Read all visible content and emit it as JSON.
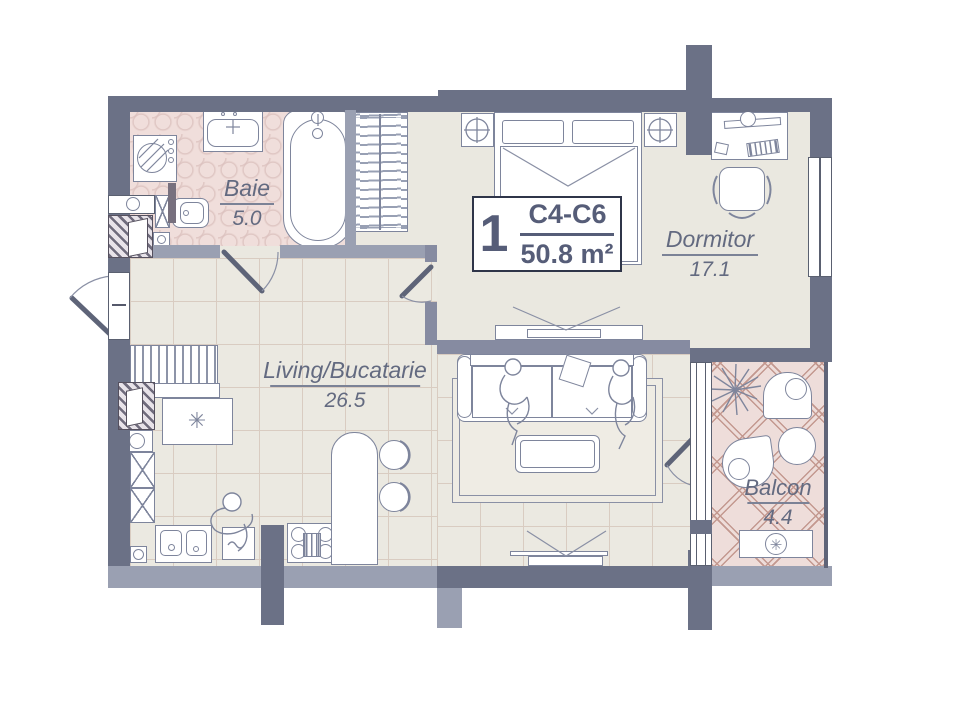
{
  "unit_badge": {
    "number": "1",
    "code": "C4-C6",
    "area": "50.8 m²"
  },
  "rooms": [
    {
      "id": "baie",
      "name": "Baie",
      "area": "5.0"
    },
    {
      "id": "dormitor",
      "name": "Dormitor",
      "area": "17.1"
    },
    {
      "id": "living",
      "name": "Living/Bucatarie",
      "area": "26.5"
    },
    {
      "id": "balcon",
      "name": "Balcon",
      "area": "4.4"
    }
  ],
  "icons": {
    "fridge_star": "✳",
    "ac_fan_star": "✳"
  },
  "colors": {
    "wall_dark": "#6b7186",
    "wall_light": "#9aa0b2",
    "wall_medium": "#868ba1",
    "floor_beige": "#eae8e0",
    "bathroom_pink": "#f0dedb",
    "balcony_pink": "#eeddda",
    "outline": "#7e859c",
    "label_text": "#636a80",
    "badge_text": "#565d78"
  }
}
